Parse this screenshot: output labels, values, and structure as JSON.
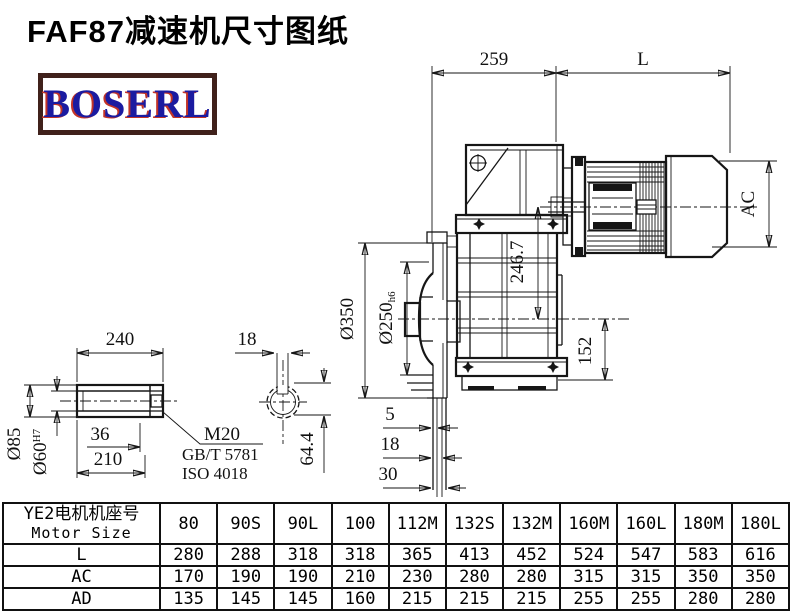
{
  "title": "FAF87减速机尺寸图纸",
  "logo": {
    "text": "BOSERL"
  },
  "drawing": {
    "dims": {
      "top_left": "259",
      "top_right": "L",
      "motor_diameter": "AC",
      "center_distance": "246.7",
      "foot_height": "152",
      "flange_od": "Ø350",
      "spigot": "Ø250",
      "spigot_fit": "h6",
      "step1": "5",
      "step2": "18",
      "step3": "30",
      "shaft_length": "240",
      "key_width": "18",
      "plug_depth": "36",
      "bore_length": "210",
      "shaft_od": "Ø85",
      "bore_d": "Ø60",
      "bore_fit": "H7",
      "key_height": "64.4",
      "thread": "M20",
      "standard1": "GB/T 5781",
      "standard2": "ISO 4018"
    }
  },
  "table": {
    "header_cn": "YE2电机机座号",
    "header_en": "Motor Size",
    "columns": [
      "80",
      "90S",
      "90L",
      "100",
      "112M",
      "132S",
      "132M",
      "160M",
      "160L",
      "180M",
      "180L"
    ],
    "rows": [
      {
        "label": "L",
        "values": [
          "280",
          "288",
          "318",
          "318",
          "365",
          "413",
          "452",
          "524",
          "547",
          "583",
          "616"
        ]
      },
      {
        "label": "AC",
        "values": [
          "170",
          "190",
          "190",
          "210",
          "230",
          "280",
          "280",
          "315",
          "315",
          "350",
          "350"
        ]
      },
      {
        "label": "AD",
        "values": [
          "135",
          "145",
          "145",
          "160",
          "215",
          "215",
          "215",
          "255",
          "255",
          "280",
          "280"
        ]
      }
    ]
  }
}
